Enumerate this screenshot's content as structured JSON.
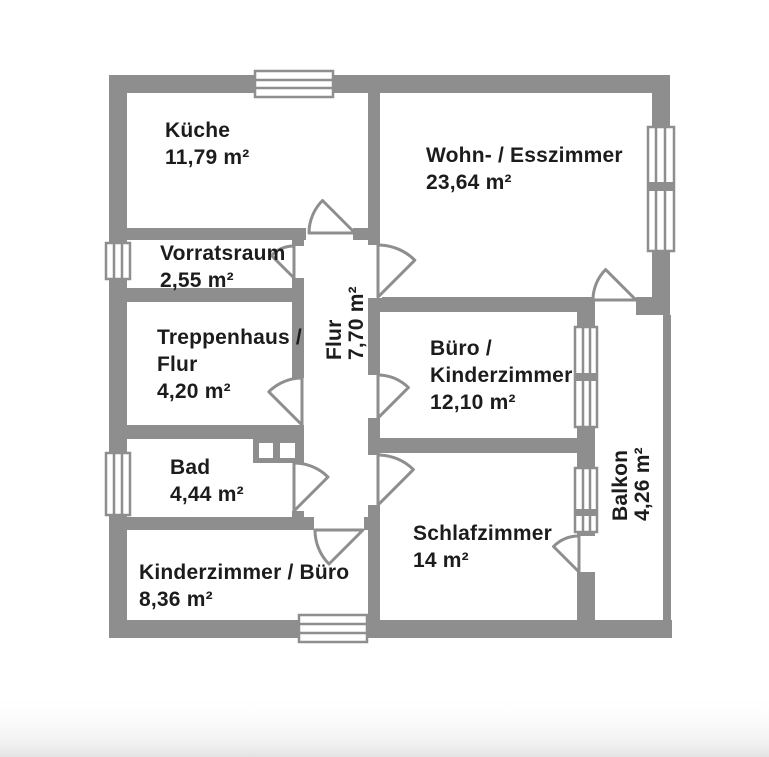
{
  "plan": {
    "type": "floorplan",
    "language": "de",
    "rooms": {
      "kueche": {
        "label": "Küche",
        "area": "11,79 m²"
      },
      "wohn_esszimmer": {
        "label": "Wohn- / Esszimmer",
        "area": "23,64 m²"
      },
      "vorratsraum": {
        "label": "Vorratsraum",
        "area": "2,55 m²"
      },
      "treppenhaus_flur": {
        "label_line1": "Treppenhaus /",
        "label_line2": "Flur",
        "area": "4,20 m²"
      },
      "flur": {
        "label": "Flur",
        "area": "7,70 m²"
      },
      "buero_kinderzimmer": {
        "label_line1": "Büro /",
        "label_line2": "Kinderzimmer",
        "area": "12,10 m²"
      },
      "bad": {
        "label": "Bad",
        "area": "4,44 m²"
      },
      "schlafzimmer": {
        "label": "Schlafzimmer",
        "area": "14 m²"
      },
      "kinderzimmer_buero": {
        "label": "Kinderzimmer / Büro",
        "area": "8,36 m²"
      },
      "balkon": {
        "label": "Balkon",
        "area": "4,26 m²"
      }
    },
    "colors": {
      "wall": "#8e8e8e",
      "text": "#1c1c1c",
      "background": "#ffffff"
    }
  }
}
